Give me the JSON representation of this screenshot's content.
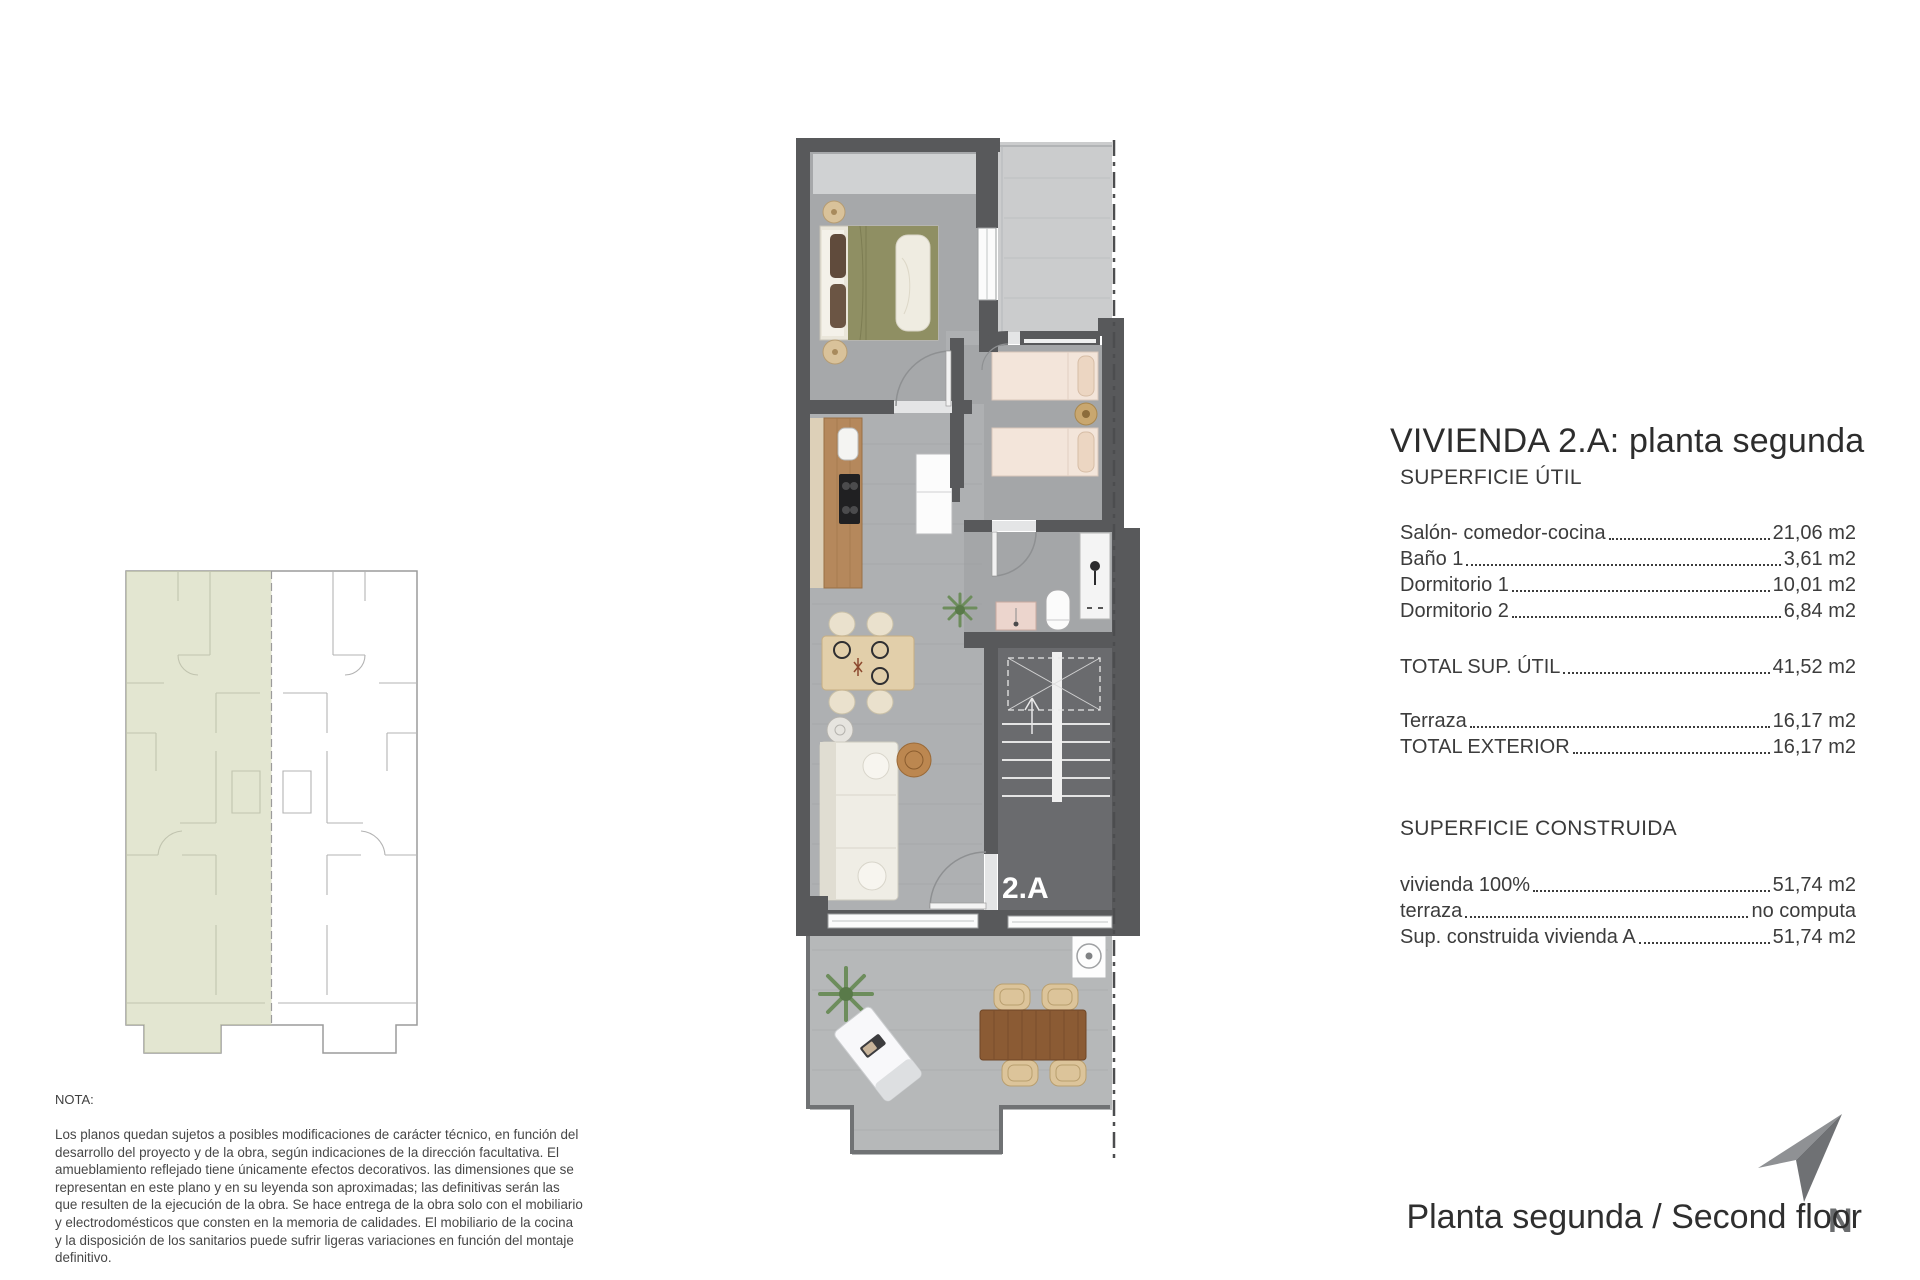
{
  "plan": {
    "unit_label": "2.A"
  },
  "nota": {
    "label": "NOTA:",
    "text": "Los planos quedan sujetos a posibles modificaciones de carácter técnico, en función del desarrollo del proyecto y de la obra, según indicaciones de la dirección facultativa. El amueblamiento reflejado tiene únicamente efectos decorativos. las dimensiones que se representan en este plano y en su leyenda son aproximadas; las definitivas serán las que resulten de la ejecución de la obra. Se hace entrega de la obra solo con el mobiliario y electrodomésticos que consten en la memoria de calidades. El mobiliario de la cocina y la disposición de los sanitarios puede sufrir ligeras variaciones en función del montaje definitivo."
  },
  "panel": {
    "title": "VIVIENDA 2.A: planta segunda",
    "superficie_util": {
      "heading": "SUPERFICIE ÚTIL",
      "rows": [
        {
          "label": "Salón- comedor-cocina",
          "value": "21,06 m2"
        },
        {
          "label": "Baño 1",
          "value": "3,61 m2"
        },
        {
          "label": "Dormitorio 1",
          "value": "10,01 m2"
        },
        {
          "label": "Dormitorio 2",
          "value": "6,84 m2"
        }
      ],
      "total": {
        "label": "TOTAL SUP. ÚTIL",
        "value": "41,52 m2"
      },
      "exterior": [
        {
          "label": "Terraza",
          "value": "16,17 m2"
        },
        {
          "label": "TOTAL EXTERIOR",
          "value": "16,17 m2"
        }
      ]
    },
    "superficie_construida": {
      "heading": "SUPERFICIE CONSTRUIDA",
      "rows": [
        {
          "label": "vivienda 100%",
          "value": "51,74 m2"
        },
        {
          "label": "terraza",
          "value": "no computa"
        },
        {
          "label": "Sup. construida vivienda A",
          "value": "51,74 m2"
        }
      ]
    }
  },
  "footer": {
    "north_label": "N",
    "caption": "Planta segunda / Second floor"
  },
  "colors": {
    "wall": "#58595b",
    "floor": "#abadaf",
    "floor_bedroom": "#a4a6a8",
    "terrace_upper": "#cbcccd",
    "terrace_lower": "#b6b8b9",
    "stairs": "#6a6b6e",
    "highlight_green": "#ccd1ab",
    "bed_olive": "#8f8f63",
    "bed_cream": "#f3e5da",
    "wood_counter": "#b5885c",
    "text": "#3f3f3f"
  }
}
